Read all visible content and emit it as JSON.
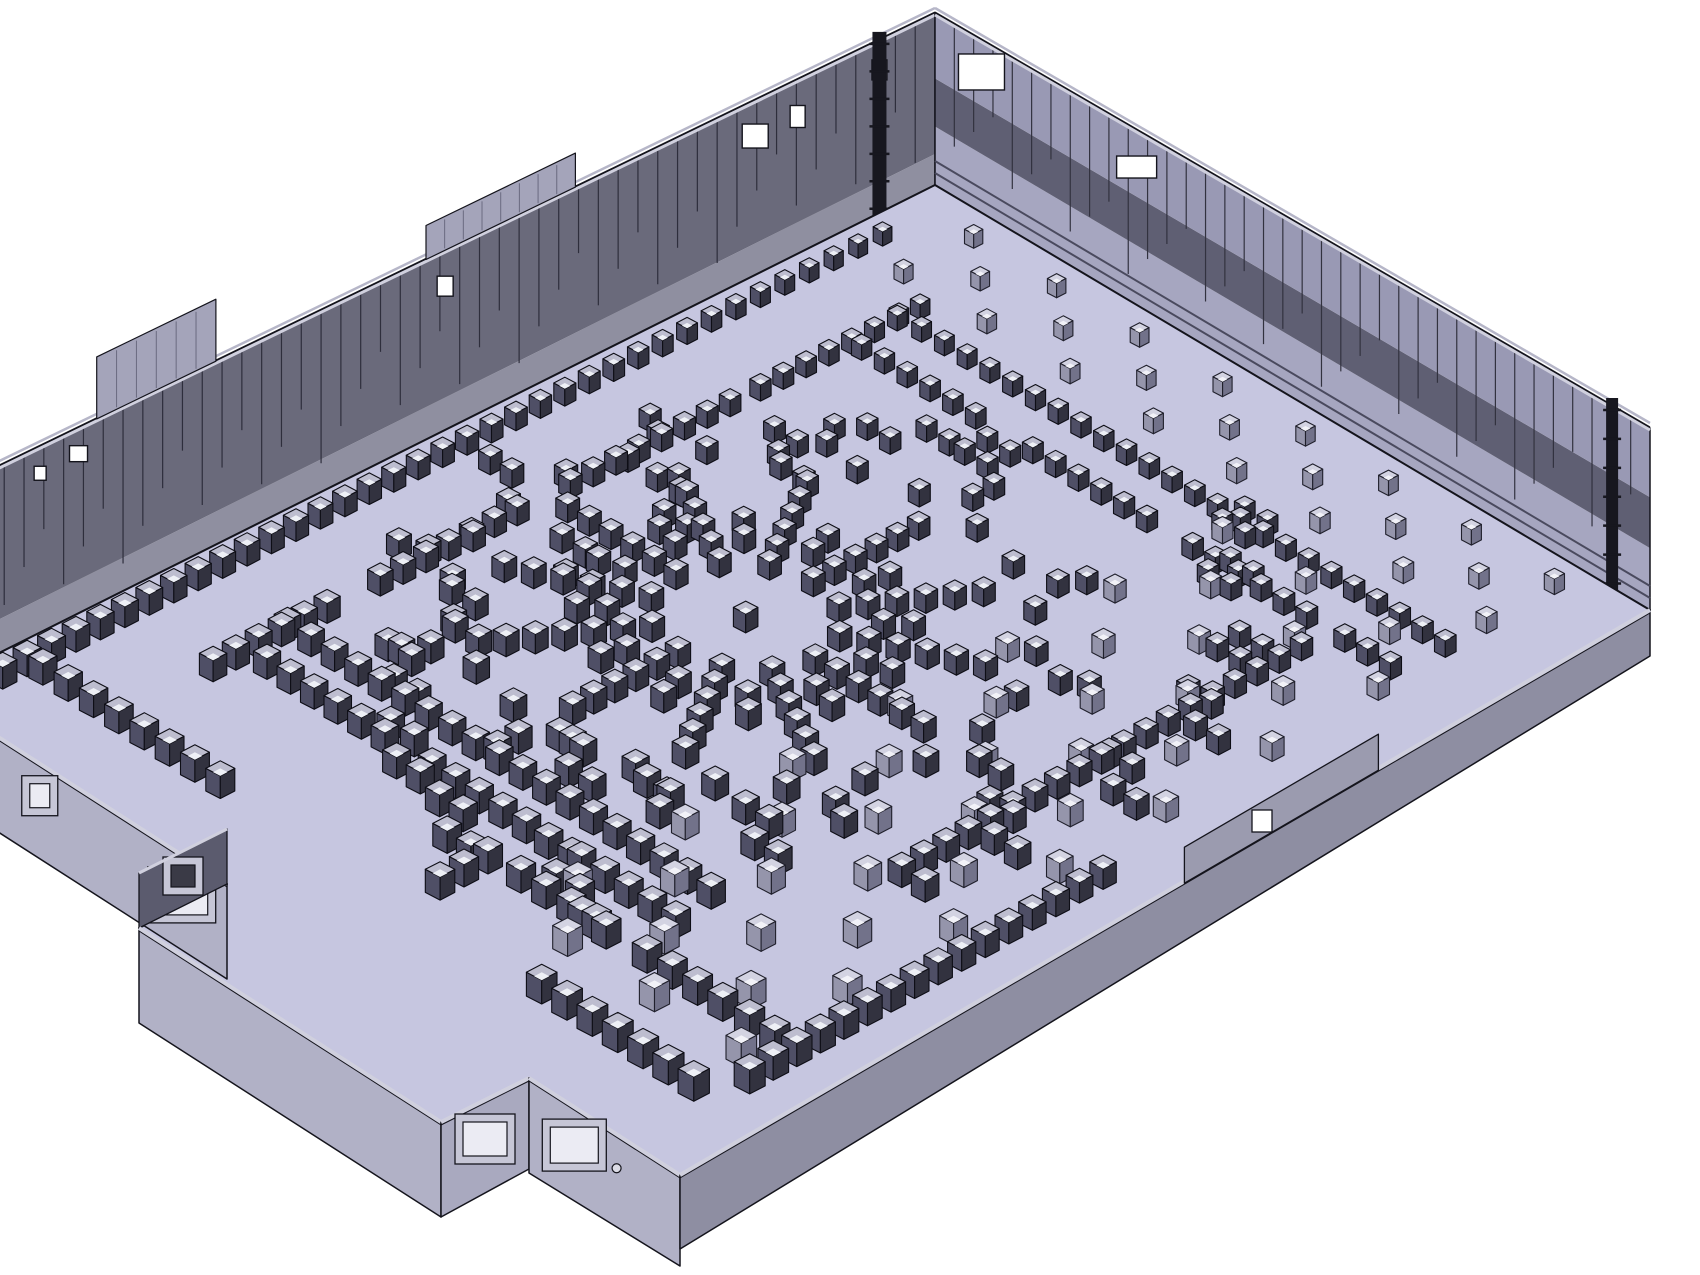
{
  "meta": {
    "description": "3D CAD isometric rendering of a large rectangular hall interior with hundreds of small cube blocks arranged in a central radial sunburst pattern, concentric arcs, dense perimeter rows, scattered pairs and sparse diagonal grids; tall striped panel walls at the back, low exterior walls and an annex room at the front-left"
  },
  "scene": {
    "canvas": {
      "w": 1700,
      "h": 1275,
      "background": "#ffffff"
    },
    "plan": {
      "W": 950,
      "D": 1320
    },
    "corners": {
      "T": [
        935,
        185
      ],
      "R": [
        1650,
        610
      ],
      "B": [
        680,
        1175
      ],
      "L": [
        -75,
        690
      ]
    },
    "colors": {
      "floor": "#c6c6e0",
      "outline": "#14141c",
      "cap_light": "#d0d0de",
      "cap_mid": "#b6b6c8",
      "stripe_dim": "#6a6a80",
      "rail": "#4a4a5e",
      "pipe": "#17171f",
      "window": "#ffffff",
      "frame": "#c6c6d6",
      "frame_opening": "#ebebf3",
      "parapet": "#a4a4ba"
    },
    "walls": {
      "back_left": {
        "a": [
          0,
          1320
        ],
        "b": [
          0,
          0
        ],
        "len": 1320,
        "hA": 188,
        "hB": 172,
        "bands": [
          {
            "f": 0.18,
            "c": "#8f8fa0"
          },
          {
            "f": 0.82,
            "c": "#6a6a7b"
          }
        ],
        "stripe_step": 26,
        "stripe_color": "#2e2e3c",
        "windows": [
          {
            "t": 0.945,
            "w": 15,
            "h": 20,
            "off": 20
          },
          {
            "t": 0.864,
            "w": 15,
            "h": 22,
            "off": 26
          },
          {
            "t": 0.822,
            "w": 26,
            "h": 24,
            "off": 24
          },
          {
            "t": 0.515,
            "w": 16,
            "h": 20,
            "off": 26
          },
          {
            "t": 0.152,
            "w": 18,
            "h": 16,
            "off": 18
          },
          {
            "t": 0.114,
            "w": 12,
            "h": 14,
            "off": 20
          }
        ],
        "parapets": [
          {
            "t0": 0.17,
            "t1": 0.288,
            "h": 62
          },
          {
            "t0": 0.496,
            "t1": 0.644,
            "h": 34
          }
        ],
        "pipes": [
          {
            "t": 0.945,
            "w": 14
          }
        ]
      },
      "back_right": {
        "a": [
          0,
          0
        ],
        "b": [
          950,
          0
        ],
        "len": 950,
        "hA": 172,
        "hB": 182,
        "bands": [
          {
            "f": 0.34,
            "c": "#a6a6c0"
          },
          {
            "f": 0.28,
            "c": "#5f5f73"
          },
          {
            "f": 0.38,
            "c": "#9999b4"
          }
        ],
        "stripe_step": 26,
        "stripe_color": "#32323f",
        "windows": [
          {
            "t": 0.065,
            "w": 46,
            "h": 36,
            "off": 14
          },
          {
            "t": 0.282,
            "w": 40,
            "h": 22,
            "off": 26
          }
        ],
        "rails": [
          12,
          24
        ],
        "pipes": [
          {
            "t": 0.947,
            "w": 12
          }
        ]
      },
      "front_left_1": {
        "p0": 0.0,
        "p1": 0.4,
        "h": 95,
        "color": "#b1b1c6",
        "framed_windows": [
          {
            "t": 0.38,
            "w": 20,
            "h": 24
          },
          {
            "t": 0.85,
            "w": 52,
            "h": 40
          }
        ]
      },
      "front_left_2": {
        "p0": 0.8,
        "p1": 1.0,
        "h": 95,
        "color": "#b1b1c6",
        "framed_windows": [
          {
            "t": 0.3,
            "w": 48,
            "h": 36
          }
        ],
        "ports": [
          {
            "t": 0.58
          }
        ]
      },
      "front_right": {
        "hA": 74,
        "hB": 46,
        "color": "#8e8ea2",
        "raised": {
          "t0": 0.52,
          "t1": 0.72,
          "rise": 34,
          "color": "#9b9baf",
          "window": {
            "t": 0.6,
            "w": 20,
            "h": 22
          }
        }
      }
    },
    "annex": {
      "p1": 0.4,
      "p2": 0.8,
      "depth": 115,
      "h": 95,
      "front_color": "#b1b1c6",
      "right_color": "#a9a9bf",
      "interior_color": "#5b5b6e",
      "interior_h": 55,
      "right_window": {
        "t": 0.5,
        "w": 44,
        "h": 34
      },
      "interior_window": {
        "w": 24,
        "h": 22
      }
    },
    "cube_styles": {
      "dark": {
        "top": "#bdbdcf",
        "left": "#4f4f66",
        "right": "#32323f",
        "edge": "#0e0e16",
        "hl": "#eef0f6"
      },
      "light": {
        "top": "#d3d3e2",
        "left": "#9595ab",
        "right": "#72728a",
        "edge": "#20202c",
        "hl": "#f2f2f8"
      }
    },
    "cube_base_size": 24,
    "cube_groups": [
      {
        "name": "left-wall-edge-row",
        "style": "dark",
        "type": "row_v",
        "u": 42,
        "v0": 110,
        "v1": 1270,
        "step": 32
      },
      {
        "name": "left-inner-row-segments",
        "style": "dark",
        "type": "segments_v",
        "u": 152,
        "segs": [
          [
            170,
            380
          ],
          [
            420,
            640
          ],
          [
            700,
            900
          ],
          [
            950,
            1120
          ]
        ],
        "step": 30
      },
      {
        "name": "top-inner-row",
        "style": "dark",
        "type": "row_u",
        "v": 196,
        "u0": 150,
        "u1": 880,
        "step": 30
      },
      {
        "name": "top-inner-row-2",
        "style": "dark",
        "type": "segments_u",
        "v": 260,
        "segs": [
          [
            165,
            330
          ],
          [
            390,
            540
          ],
          [
            600,
            760
          ],
          [
            800,
            875
          ]
        ],
        "step": 30
      },
      {
        "name": "mid-right-row",
        "style": "dark",
        "type": "row_v",
        "u": 782,
        "v0": 300,
        "v1": 820,
        "step": 30
      },
      {
        "name": "bottom-row-1",
        "style": "dark",
        "type": "row_u",
        "v": 1000,
        "u0": 150,
        "u1": 700,
        "step": 30
      },
      {
        "name": "bottom-row-2",
        "style": "dark",
        "type": "segments_u",
        "v": 1058,
        "segs": [
          [
            180,
            330
          ],
          [
            390,
            530
          ],
          [
            580,
            700
          ]
        ],
        "step": 30
      },
      {
        "name": "bottom-row-3",
        "style": "dark",
        "type": "segments_u",
        "v": 1118,
        "segs": [
          [
            560,
            660
          ],
          [
            720,
            820
          ],
          [
            850,
            900
          ]
        ],
        "step": 32
      },
      {
        "name": "bottom-left-edge-row",
        "style": "dark",
        "type": "row_u",
        "v": 1228,
        "u0": 60,
        "u1": 300,
        "step": 32
      },
      {
        "name": "bottom-right-edge-row",
        "style": "dark",
        "type": "row_u",
        "v": 1228,
        "u0": 690,
        "u1": 900,
        "step": 32
      },
      {
        "name": "right-edge-column",
        "style": "dark",
        "type": "row_v",
        "u": 908,
        "v0": 700,
        "v1": 1205,
        "step": 32
      },
      {
        "name": "annex-side-column",
        "style": "dark",
        "type": "row_v",
        "u": 520,
        "v0": 1120,
        "v1": 1205,
        "step": 32
      },
      {
        "name": "back-strip-grid",
        "style": "light",
        "type": "checker",
        "u0": 100,
        "u1": 900,
        "du": 110,
        "v0": 48,
        "v1": 140,
        "dv": 46
      },
      {
        "name": "right-area-grid",
        "style": "light",
        "type": "checker",
        "u0": 600,
        "u1": 880,
        "du": 110,
        "v0": 220,
        "v1": 1170,
        "dv": 72
      },
      {
        "name": "radial-sunburst",
        "style": "dark",
        "type": "radial",
        "cu": 408,
        "cv": 660,
        "spokes": 12,
        "spoke_r": [
          90,
          118,
          146,
          174,
          202,
          230
        ],
        "inner_pair_r": [
          128,
          156
        ],
        "arc_r": 272,
        "arc_spread": 7,
        "outer_pair_r": [
          302,
          330
        ]
      },
      {
        "name": "scattered-pairs",
        "style": "dark",
        "type": "pairs",
        "gap": 30,
        "positions": [
          [
            210,
            420
          ],
          [
            256,
            458
          ],
          [
            196,
            560
          ],
          [
            242,
            598
          ],
          [
            210,
            700
          ],
          [
            254,
            740
          ],
          [
            205,
            840
          ],
          [
            248,
            880
          ],
          [
            230,
            950
          ],
          [
            274,
            988
          ],
          [
            320,
            1040
          ],
          [
            364,
            1078
          ],
          [
            430,
            1090
          ],
          [
            474,
            1126
          ],
          [
            540,
            1060
          ],
          [
            584,
            1096
          ],
          [
            640,
            1120
          ],
          [
            300,
            310
          ],
          [
            262,
            350
          ],
          [
            760,
            430
          ],
          [
            804,
            466
          ],
          [
            782,
            560
          ],
          [
            824,
            598
          ],
          [
            762,
            700
          ],
          [
            804,
            738
          ],
          [
            782,
            840
          ],
          [
            430,
            930
          ],
          [
            474,
            964
          ],
          [
            532,
            920
          ],
          [
            620,
            880
          ],
          [
            664,
            914
          ]
        ]
      },
      {
        "name": "small-square-clusters",
        "style": "dark",
        "type": "quads",
        "size": 30,
        "positions": [
          [
            350,
            280
          ],
          [
            640,
            250
          ],
          [
            730,
            330
          ],
          [
            590,
            180
          ]
        ]
      }
    ]
  }
}
